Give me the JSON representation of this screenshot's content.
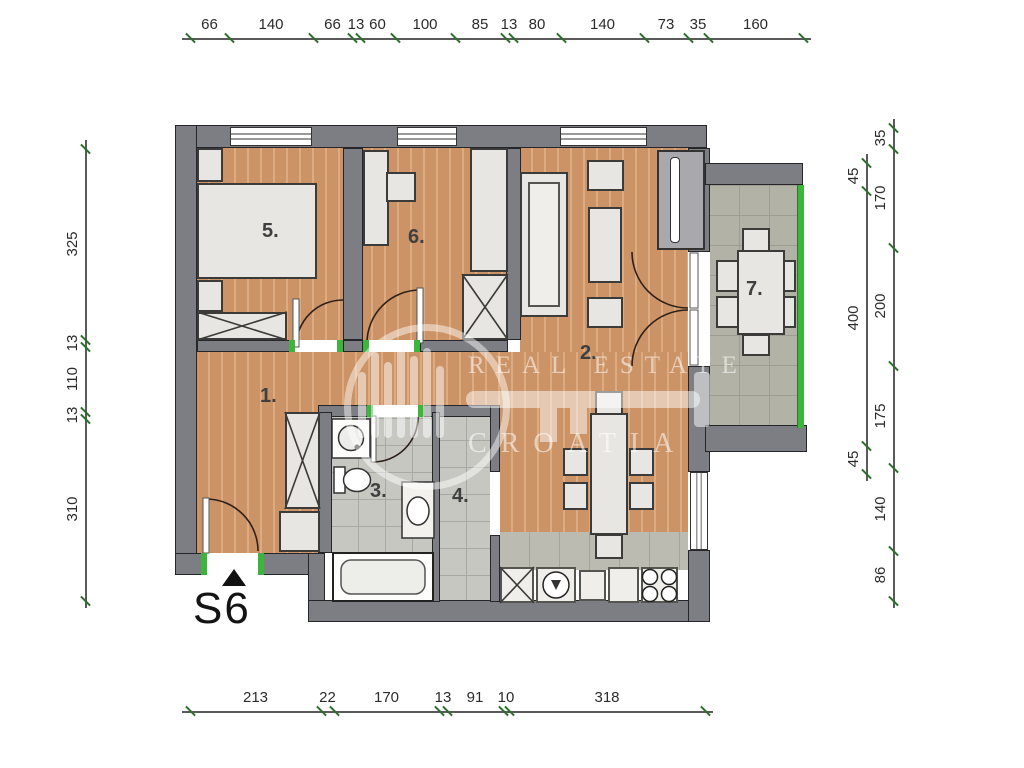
{
  "plan": {
    "unit_label": "S6"
  },
  "watermark": {
    "line1": "REAL ESTATE",
    "line2": "CROATIA"
  },
  "rooms": {
    "r1": "1.",
    "r2": "2.",
    "r3": "3.",
    "r4": "4.",
    "r5": "5.",
    "r6": "6.",
    "r7": "7."
  },
  "dimensions": {
    "top": [
      "66",
      "140",
      "66",
      "13",
      "60",
      "100",
      "85",
      "13",
      "80",
      "140",
      "73",
      "35",
      "160"
    ],
    "left": [
      "325",
      "13",
      "110",
      "13",
      "310"
    ],
    "right_inner": [
      "45",
      "400",
      "45"
    ],
    "right_outer": [
      "35",
      "170",
      "200",
      "175",
      "140",
      "86"
    ],
    "bottom": [
      "213",
      "22",
      "170",
      "13",
      "91",
      "10",
      "318"
    ]
  },
  "colors": {
    "wall": "#7d7e83",
    "wood_floor": "#cb9366",
    "bath_tile": "#c7c7c2",
    "terrace_tile": "#b3b2a6",
    "kitchen_tile": "#bcbbb2",
    "accent_green": "#3db53d",
    "furniture": "#e7e6e2"
  }
}
